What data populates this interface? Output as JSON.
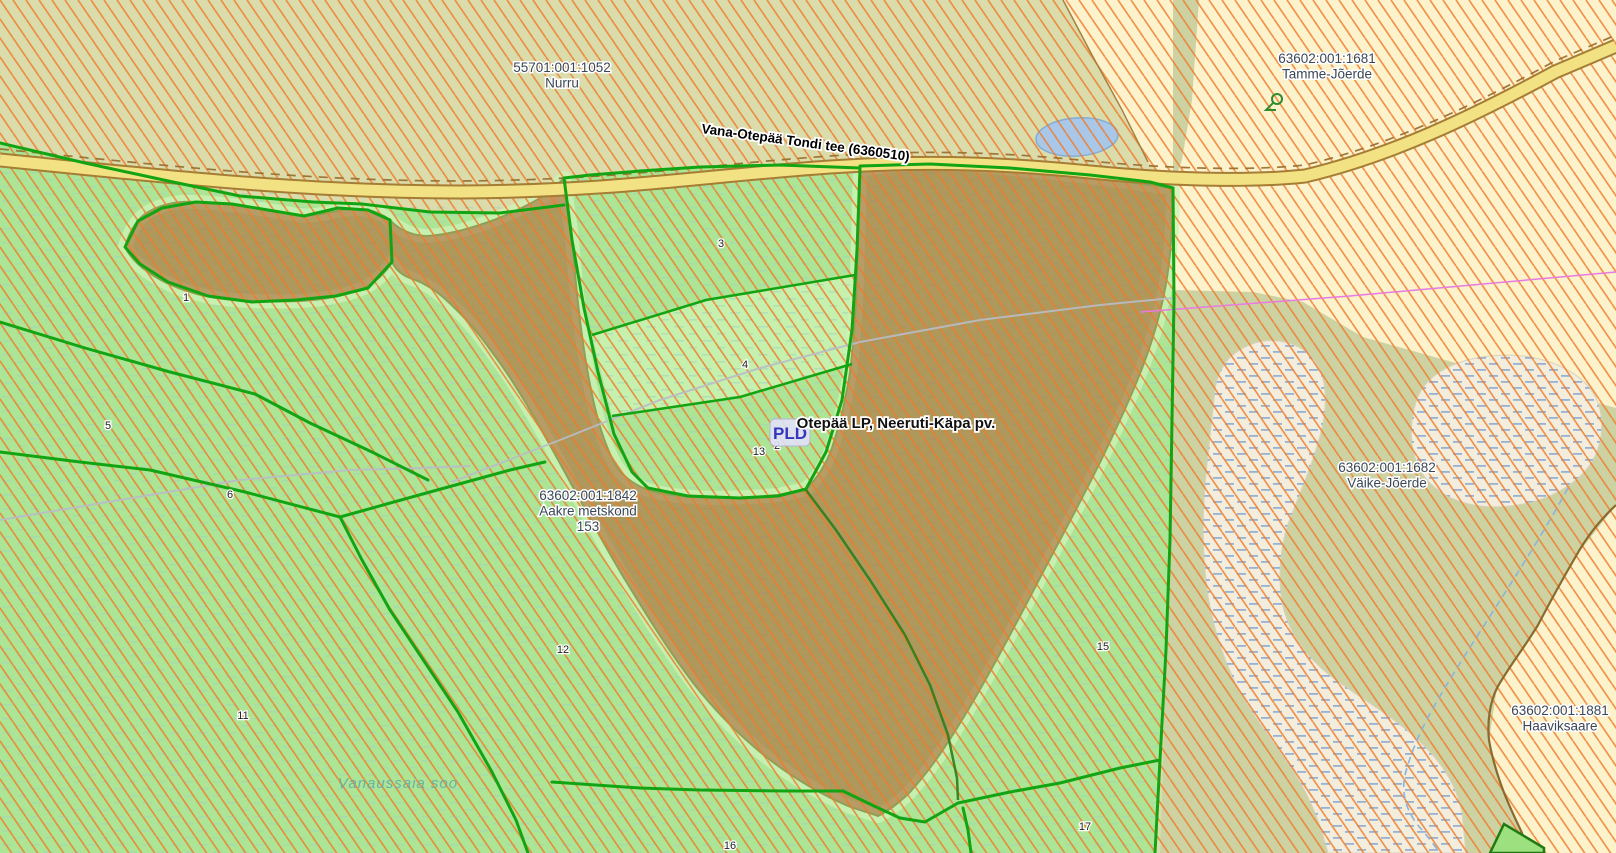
{
  "map": {
    "title": "Cadastral map view",
    "colors": {
      "hatch": "#F07A28",
      "parcel_boundary": "#12A412",
      "forest_green": "#ACE595",
      "field_khaki": "#DBDCAB",
      "field_yellow": "#FCF2CC",
      "field_olive": "#CDD2A3",
      "wetland": "#F2EDDC",
      "protected_overlay": "#B06A38",
      "road_fill": "#F3E283",
      "road_casing": "#A57D35",
      "pond": "#A9C8E9",
      "stream": "#8AB4DC",
      "magenta": "#E87AE0",
      "label": "#3B4756",
      "pld_blue": "#3535C0",
      "bog_teal": "#62ACA4"
    },
    "region_labels": [
      {
        "id": "nurru",
        "lines": [
          "55701:001:1052",
          "Nurru"
        ],
        "x": 562,
        "y": 72
      },
      {
        "id": "tamme-joerde",
        "lines": [
          "63602:001:1681",
          "Tamme-Jõerde"
        ],
        "x": 1327,
        "y": 63
      },
      {
        "id": "vaike-joerde",
        "lines": [
          "63602:001:1682",
          "Väike-Jõerde"
        ],
        "x": 1387,
        "y": 472
      },
      {
        "id": "haaviksaare",
        "lines": [
          "63602:001:1881",
          "Haaviksaare"
        ],
        "x": 1560,
        "y": 715
      },
      {
        "id": "aakre-metskond",
        "lines": [
          "63602:001:1842",
          "Aakre metskond",
          "153"
        ],
        "x": 588,
        "y": 500
      }
    ],
    "road_label": {
      "text": "Vana-Otepää Tondi tee (6360510)",
      "x": 805,
      "y": 147,
      "angle": 7.7
    },
    "protected_area_label": {
      "text": "Otepää LP, Neeruti-Käpa pv.",
      "x": 896,
      "y": 428
    },
    "pld_marker": {
      "text": "PLD",
      "x": 790,
      "y": 439
    },
    "bog_label": {
      "text": "Vanaussaia soo",
      "x": 398,
      "y": 788
    },
    "parcel_numbers": [
      {
        "n": "1",
        "x": 186,
        "y": 301
      },
      {
        "n": "3",
        "x": 721,
        "y": 247
      },
      {
        "n": "4",
        "x": 745,
        "y": 368
      },
      {
        "n": "5",
        "x": 108,
        "y": 429
      },
      {
        "n": "6",
        "x": 230,
        "y": 498
      },
      {
        "n": "11",
        "x": 243,
        "y": 719
      },
      {
        "n": "12",
        "x": 563,
        "y": 653
      },
      {
        "n": "13",
        "x": 759,
        "y": 455
      },
      {
        "n": "2",
        "x": 777,
        "y": 449
      },
      {
        "n": "15",
        "x": 1103,
        "y": 650
      },
      {
        "n": "16",
        "x": 730,
        "y": 849
      },
      {
        "n": "17",
        "x": 1085,
        "y": 830
      }
    ]
  }
}
